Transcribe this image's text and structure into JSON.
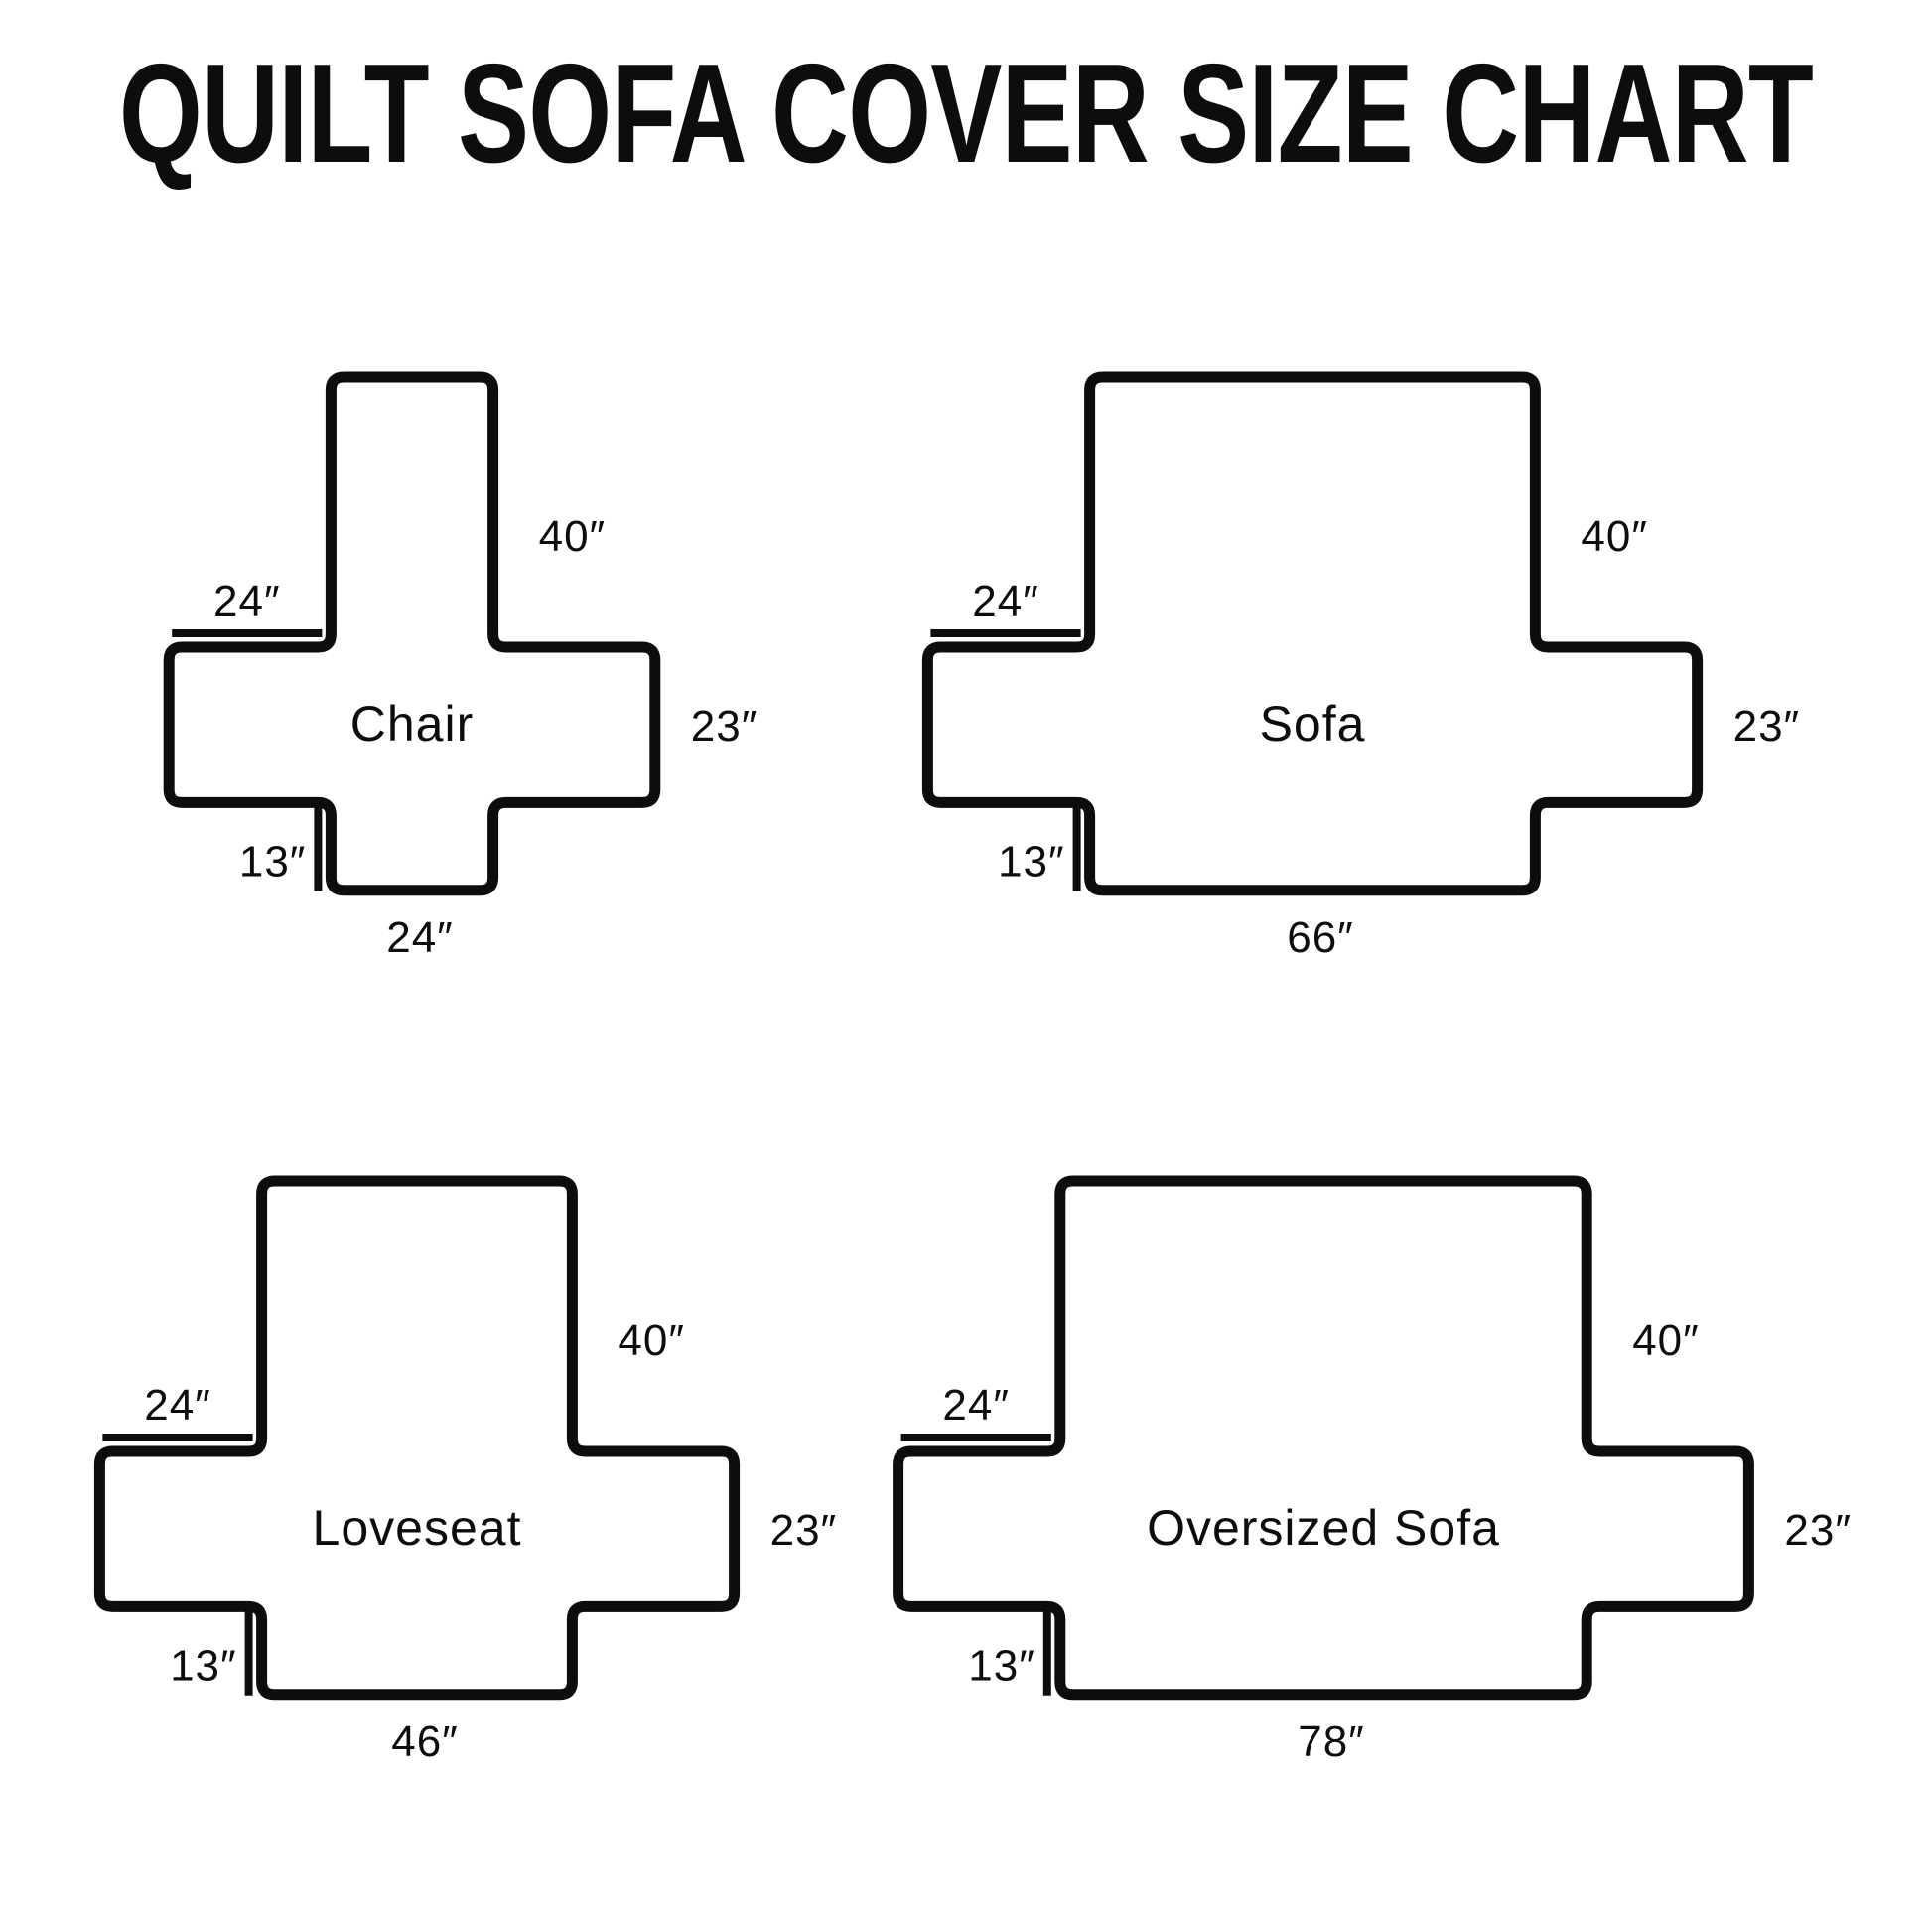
{
  "title": "QUILT SOFA COVER SIZE CHART",
  "diagram": {
    "unit": "inches",
    "unit_mark": "″",
    "shapes": [
      {
        "id": "chair",
        "name": "Chair",
        "back_height_in": 40,
        "arm_extension_in": 24,
        "arm_side_in": 23,
        "skirt_depth_in": 13,
        "bottom_width_in": 24,
        "labels": {
          "back_height": "40″",
          "arm_extension": "24″",
          "arm_side": "23″",
          "skirt_depth": "13″",
          "bottom_width": "24″"
        }
      },
      {
        "id": "sofa",
        "name": "Sofa",
        "back_height_in": 40,
        "arm_extension_in": 24,
        "arm_side_in": 23,
        "skirt_depth_in": 13,
        "bottom_width_in": 66,
        "labels": {
          "back_height": "40″",
          "arm_extension": "24″",
          "arm_side": "23″",
          "skirt_depth": "13″",
          "bottom_width": "66″"
        }
      },
      {
        "id": "loveseat",
        "name": "Loveseat",
        "back_height_in": 40,
        "arm_extension_in": 24,
        "arm_side_in": 23,
        "skirt_depth_in": 13,
        "bottom_width_in": 46,
        "labels": {
          "back_height": "40″",
          "arm_extension": "24″",
          "arm_side": "23″",
          "skirt_depth": "13″",
          "bottom_width": "46″"
        }
      },
      {
        "id": "oversized-sofa",
        "name": "Oversized Sofa",
        "back_height_in": 40,
        "arm_extension_in": 24,
        "arm_side_in": 23,
        "skirt_depth_in": 13,
        "bottom_width_in": 78,
        "labels": {
          "back_height": "40″",
          "arm_extension": "24″",
          "arm_side": "23″",
          "skirt_depth": "13″",
          "bottom_width": "78″"
        }
      }
    ]
  },
  "colors": {
    "line": "#0d0d0d",
    "text": "#0d0d0d",
    "background": "#ffffff"
  }
}
